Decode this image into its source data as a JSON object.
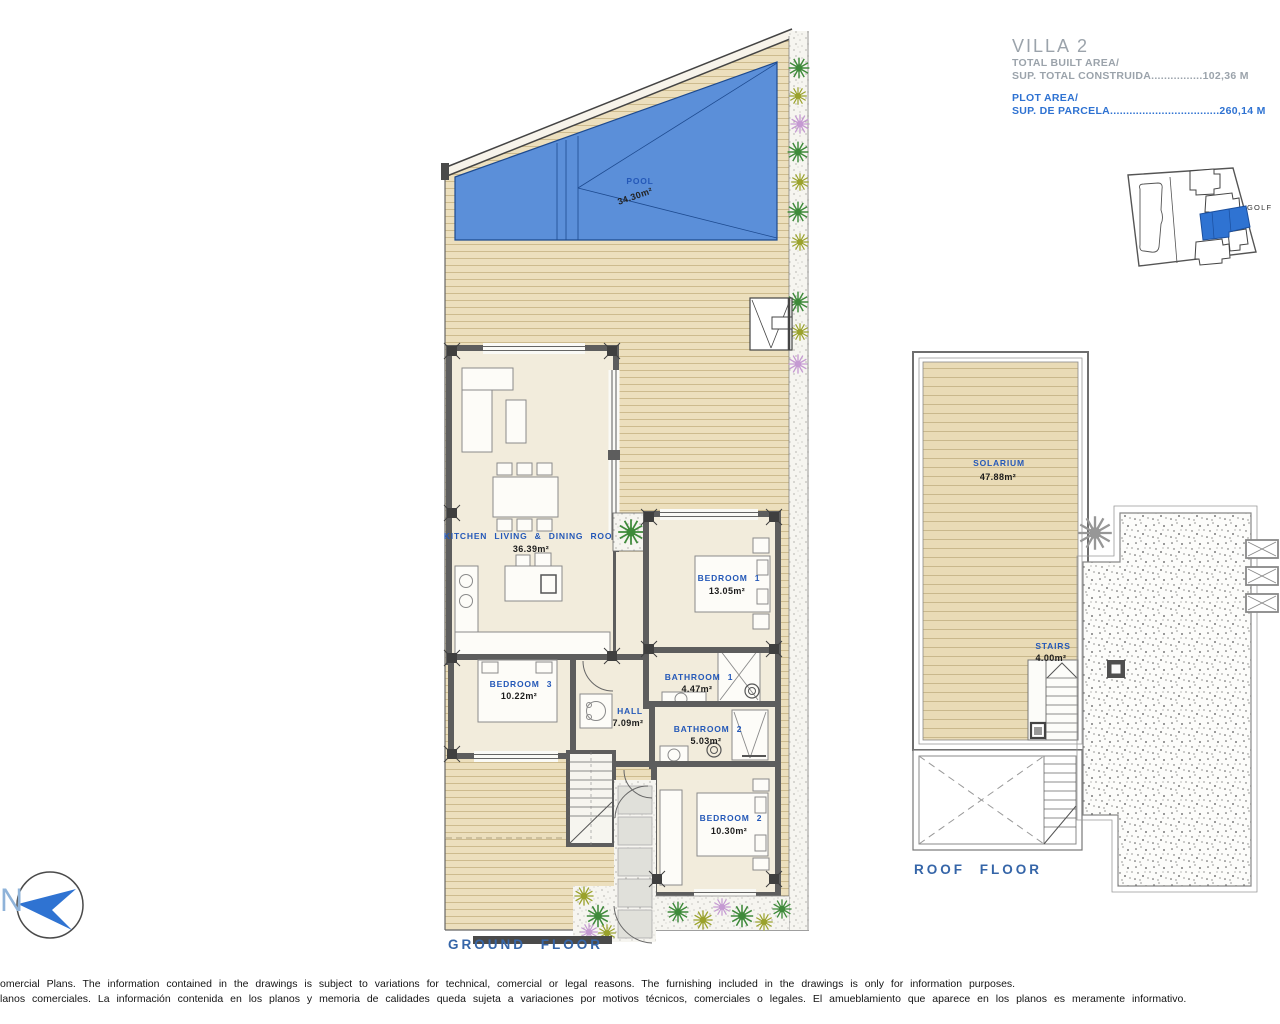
{
  "title_block": {
    "title": "VILLA 2",
    "built_area_label": "TOTAL BUILT AREA/",
    "built_area_value": "SUP. TOTAL CONSTRUIDA................102,36 M",
    "plot_area_label": "PLOT AREA/",
    "plot_area_value": "SUP. DE PARCELA..................................260,14 M"
  },
  "site_plan": {
    "golf_label": "GOLF"
  },
  "north_label": "N",
  "ground_floor": {
    "title": "GROUND FLOOR",
    "pool": {
      "name": "POOL",
      "area": "34.30m²"
    },
    "kitchen": {
      "name": "KITCHEN LIVING & DINING ROOM",
      "area": "36.39m²"
    },
    "bedroom1": {
      "name": "BEDROOM 1",
      "area": "13.05m²"
    },
    "bathroom1": {
      "name": "BATHROOM 1",
      "area": "4.47m²"
    },
    "bedroom3": {
      "name": "BEDROOM 3",
      "area": "10.22m²"
    },
    "hall": {
      "name": "HALL",
      "area": "7.09m²"
    },
    "bathroom2": {
      "name": "BATHROOM 2",
      "area": "5.03m²"
    },
    "bedroom2": {
      "name": "BEDROOM 2",
      "area": "10.30m²"
    }
  },
  "roof_floor": {
    "title": "ROOF FLOOR",
    "solarium": {
      "name": "SOLARIUM",
      "area": "47.88m²"
    },
    "stairs": {
      "name": "STAIRS",
      "area": "4.00m²"
    }
  },
  "disclaimer": {
    "line1": "omercial Plans. The information contained in the drawings is subject to variations for technical, comercial or legal reasons. The furnishing included in the drawings is only for information purposes.",
    "line2": "lanos comerciales. La información contenida en los planos y memoria de calidades queda sujeta a variaciones por motivos técnicos, comerciales o legales. El amueblamiento que aparece en los planos es meramente informativo."
  },
  "colors": {
    "accent_blue": "#2e72d2",
    "label_blue": "#2458b8",
    "pool_blue": "#5b8fd9",
    "deck_tan": "#ecdfbd",
    "wall_gray": "#5d5d5d",
    "title_gray": "#9ba3ab",
    "floor_label_blue": "#3565a8"
  }
}
